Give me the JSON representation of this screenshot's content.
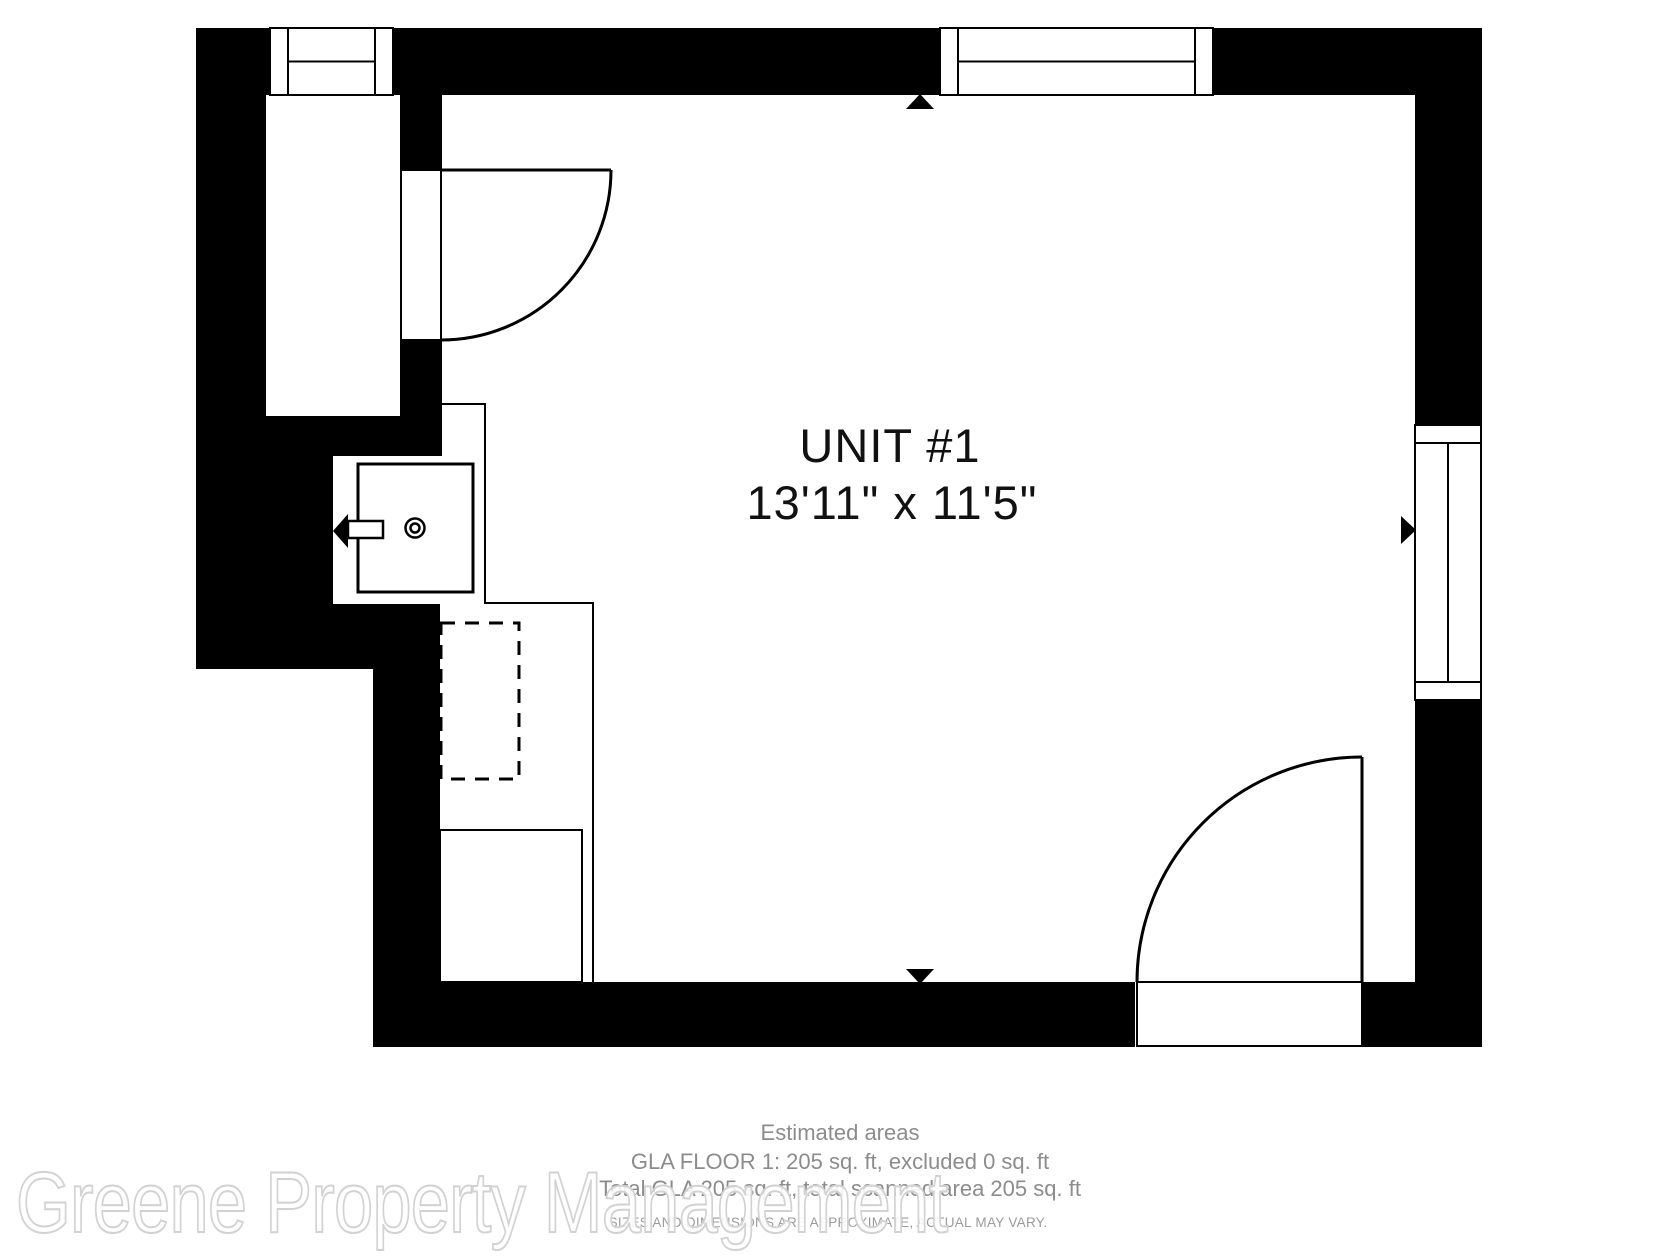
{
  "title": "Floor plan - UNIT #1",
  "colors": {
    "bg": "#ffffff",
    "wall": "#000000",
    "footer_text": "#8c8c8c",
    "disclaimer_text": "#9b9b9b",
    "watermark_outline": "#d2d2d2"
  },
  "room": {
    "name": "UNIT #1",
    "dimensions": "13'11\" x 11'5\""
  },
  "footer": {
    "heading": "Estimated areas",
    "line1": "GLA FLOOR 1: 205 sq. ft, excluded 0 sq. ft",
    "line2": "Total GLA 205 sq. ft, total scanned area 205 sq. ft",
    "disclaimer": "SIZES AND DIMENSIONS ARE APPROXIMATE, ACTUAL MAY VARY."
  },
  "watermark": {
    "text": "Greene Property Management"
  },
  "symbols": {
    "windows": [
      "window-top-left",
      "window-top-right",
      "window-right"
    ],
    "doors": [
      "door-top-left",
      "door-bottom-right"
    ],
    "fixtures": [
      "sink",
      "dashed-appliance",
      "counter"
    ],
    "markers": [
      "arrow-top",
      "arrow-bottom",
      "arrow-right",
      "sink-faucet-arrow"
    ]
  }
}
